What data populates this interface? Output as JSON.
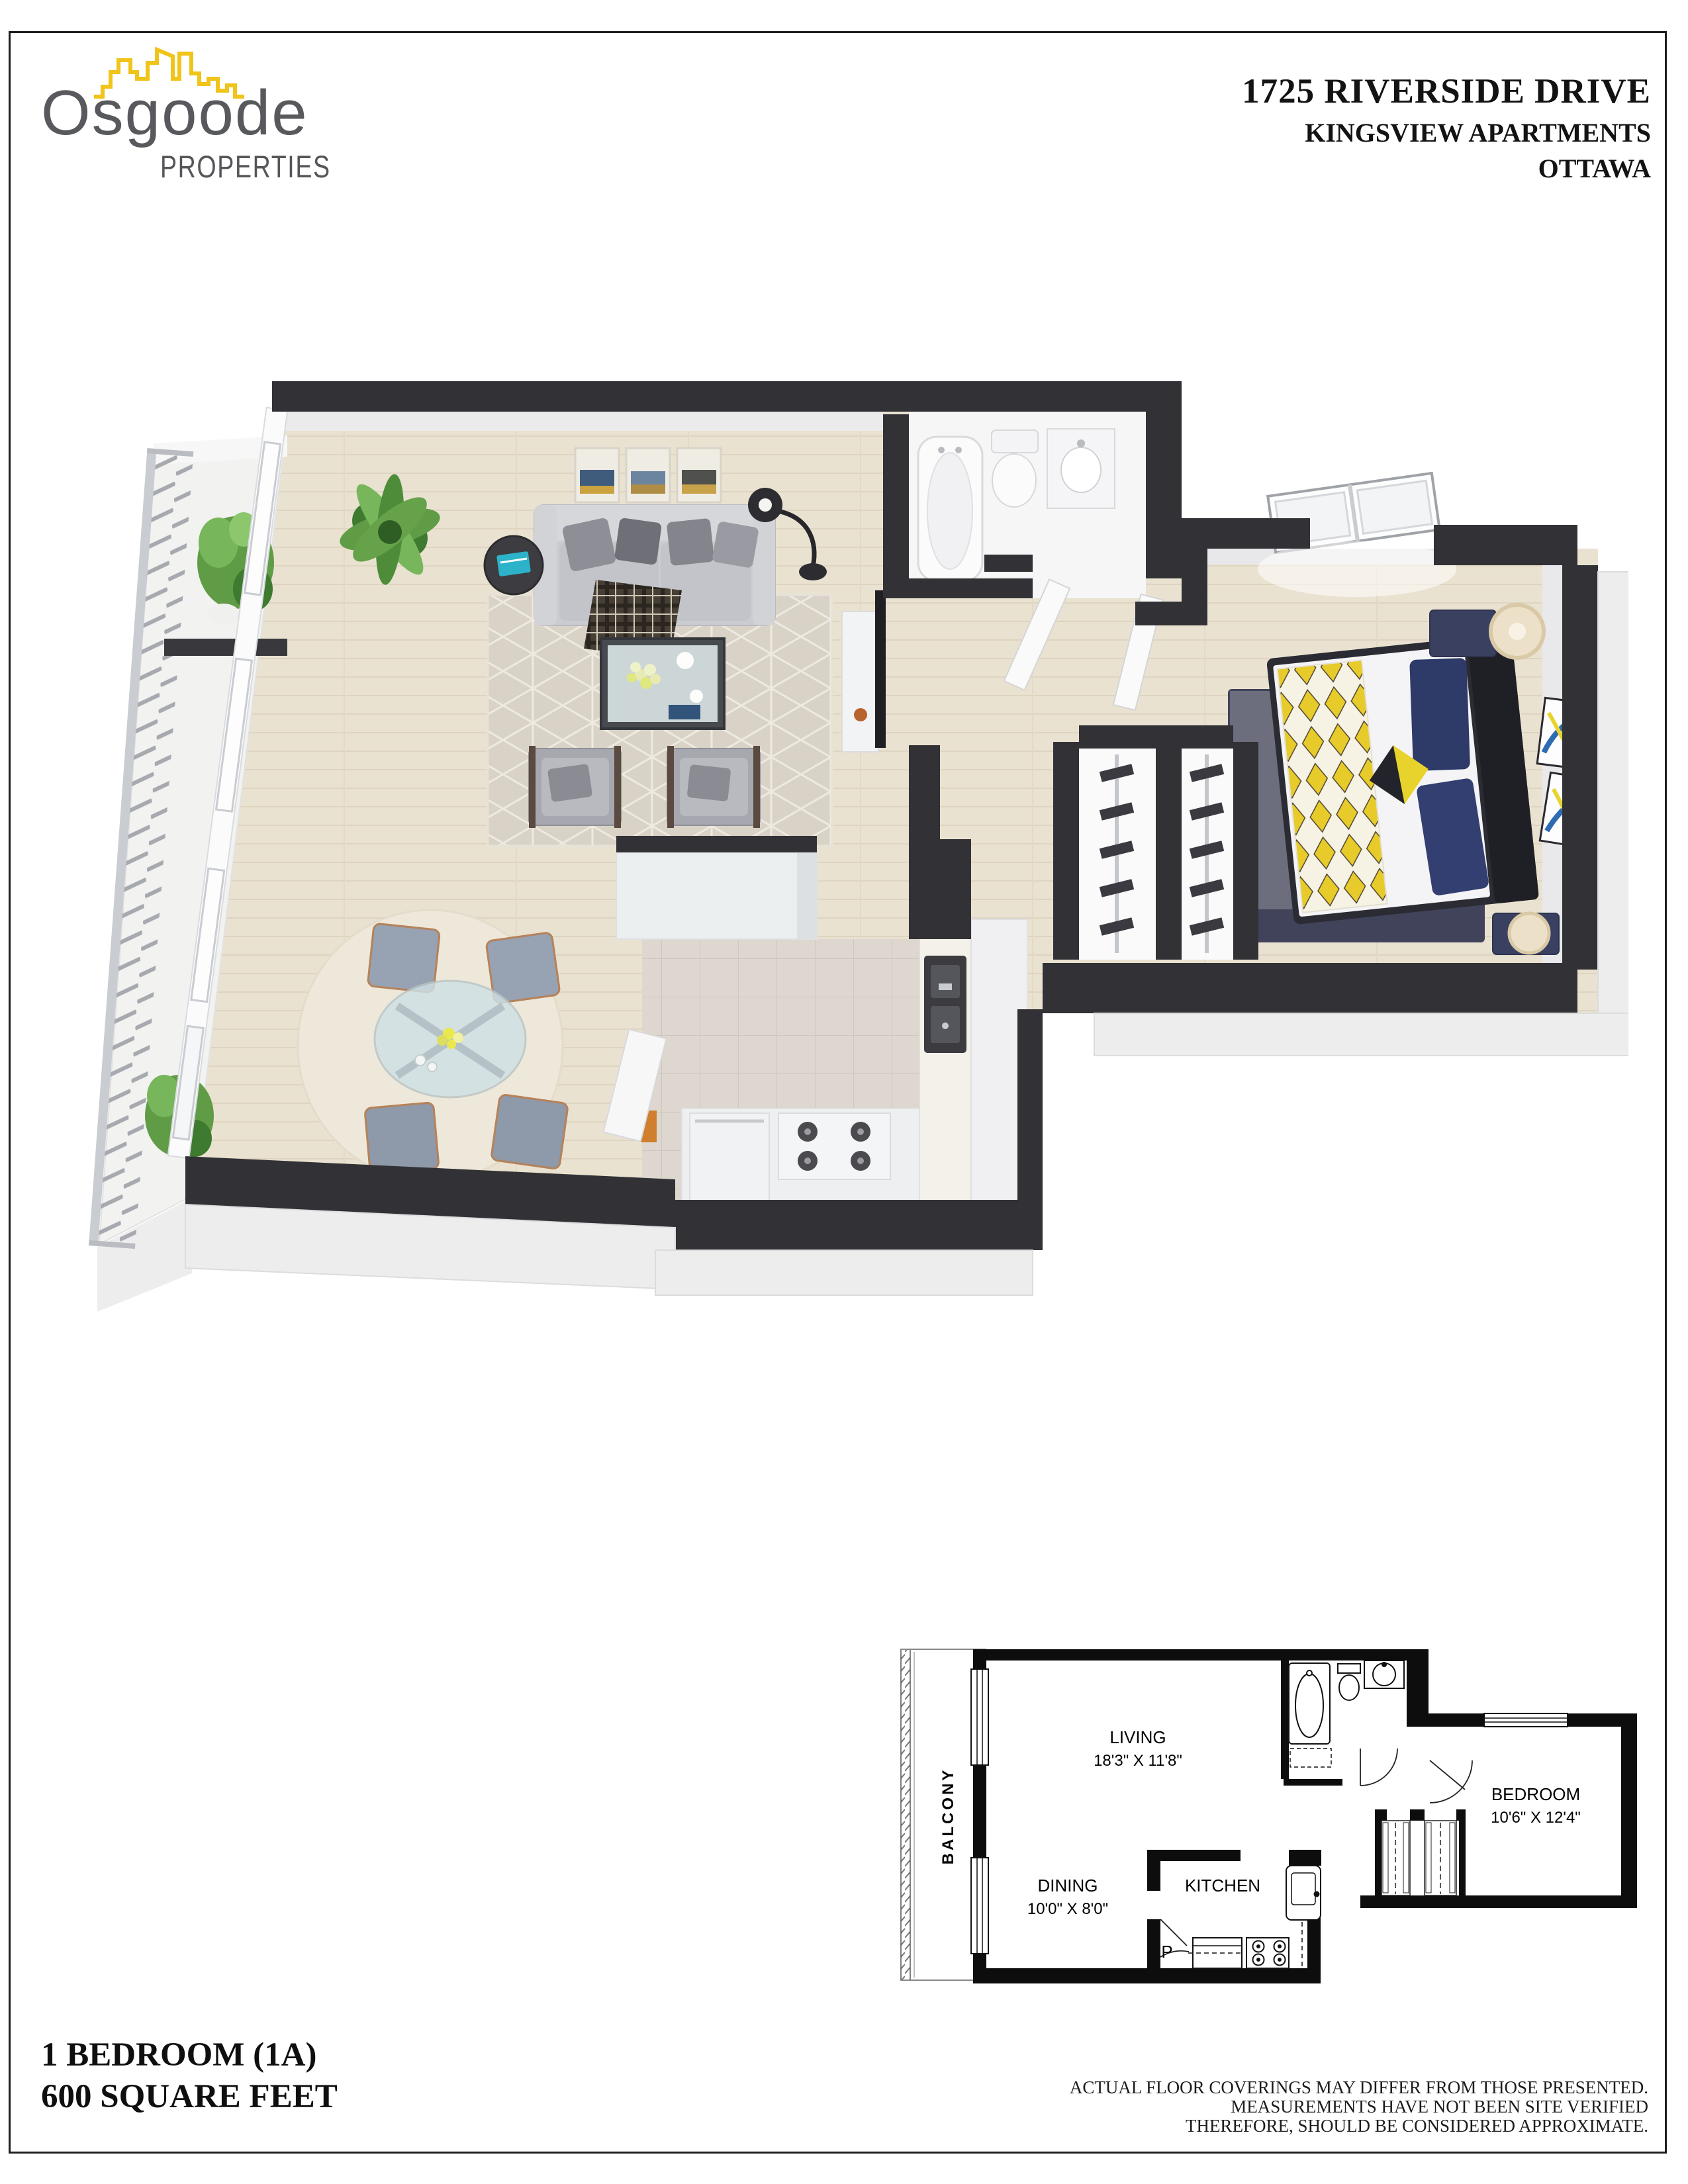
{
  "brand": {
    "name": "Osgoode",
    "subtitle": "PROPERTIES",
    "skyline_color": "#f0c419",
    "text_color": "#58595d"
  },
  "header": {
    "line1": "1725 RIVERSIDE DRIVE",
    "line2": "KINGSVIEW APARTMENTS",
    "line3": "OTTAWA"
  },
  "footer": {
    "unit_type": "1 BEDROOM (1A)",
    "area": "600 SQUARE FEET"
  },
  "disclaimer": {
    "line1": "ACTUAL FLOOR COVERINGS MAY DIFFER FROM THOSE PRESENTED.",
    "line2": "MEASUREMENTS HAVE NOT BEEN SITE VERIFIED",
    "line3": "THEREFORE, SHOULD BE CONSIDERED APPROXIMATE."
  },
  "plan2d": {
    "balcony": "BALCONY",
    "living": "LIVING",
    "living_dims": "18'3\" X 11'8\"",
    "dining": "DINING",
    "dining_dims": "10'0\" X 8'0\"",
    "kitchen": "KITCHEN",
    "bedroom": "BEDROOM",
    "bedroom_dims": "10'6\" X 12'4\"",
    "pantry": "P"
  },
  "plan3d": {
    "rooms": [
      "balcony",
      "living",
      "dining",
      "kitchen",
      "bathroom",
      "hall",
      "bedroom",
      "closets"
    ],
    "colors": {
      "walls": "#323236",
      "wood_floor": "#eae2d1",
      "kitchen_tile": "#ded7cf",
      "living_rug": "#d9d3c7",
      "dining_rug": "#eee8da",
      "bedroom_rug": "#40435a",
      "bed_navy": "#2e3a68",
      "accent_yellow": "#e7cb2a",
      "sofa_gray": "#cbccd1"
    }
  }
}
